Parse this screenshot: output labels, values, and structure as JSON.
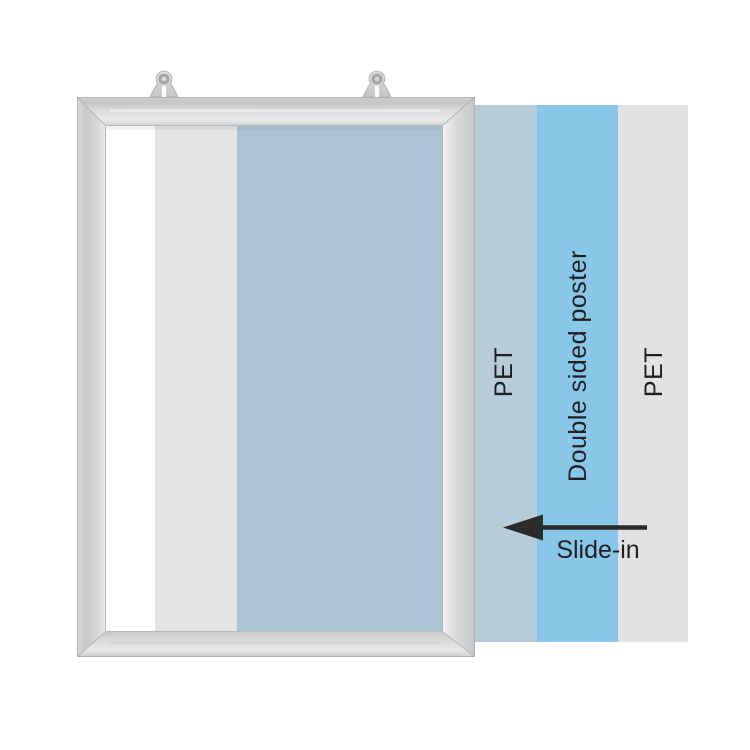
{
  "illustration": {
    "title_hint": "slide-in poster frame diagram",
    "layers": {
      "pet_front": {
        "label": "PET",
        "color": "#b7ccd9"
      },
      "poster": {
        "label": "Double sided poster",
        "color": "#88c7e8"
      },
      "pet_back": {
        "label": "PET",
        "color": "#e0e2e4"
      }
    },
    "action": {
      "label": "Slide-in",
      "arrow_color": "#2b2b2b"
    },
    "inside": {
      "backing": "#ffffff",
      "pet_tint": "#e3e4e6",
      "poster_tint": "#abc4d3"
    },
    "frame_color": "#d5d6d8",
    "text_color": "#231f20"
  }
}
